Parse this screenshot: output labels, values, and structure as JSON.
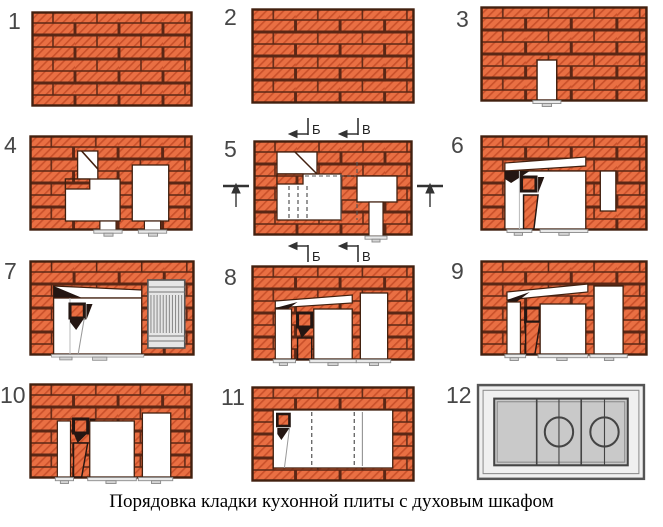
{
  "caption": "Порядовка кладки кухонной плиты с духовым шкафом",
  "section_labels": {
    "b": "Б",
    "v": "В"
  },
  "figures": [
    {
      "num": "1"
    },
    {
      "num": "2"
    },
    {
      "num": "3"
    },
    {
      "num": "4"
    },
    {
      "num": "5"
    },
    {
      "num": "6"
    },
    {
      "num": "7"
    },
    {
      "num": "8"
    },
    {
      "num": "9"
    },
    {
      "num": "10"
    },
    {
      "num": "11"
    },
    {
      "num": "12"
    }
  ],
  "colors": {
    "brick": "#e96f43",
    "brick_hatch": "#c9502a",
    "mortar_joint": "#5b2715",
    "outline": "#42200f",
    "shadow": "#241612",
    "metal_light": "#e9e9e9",
    "metal_plate": "#c9c9c9",
    "number_gray": "#474747"
  }
}
